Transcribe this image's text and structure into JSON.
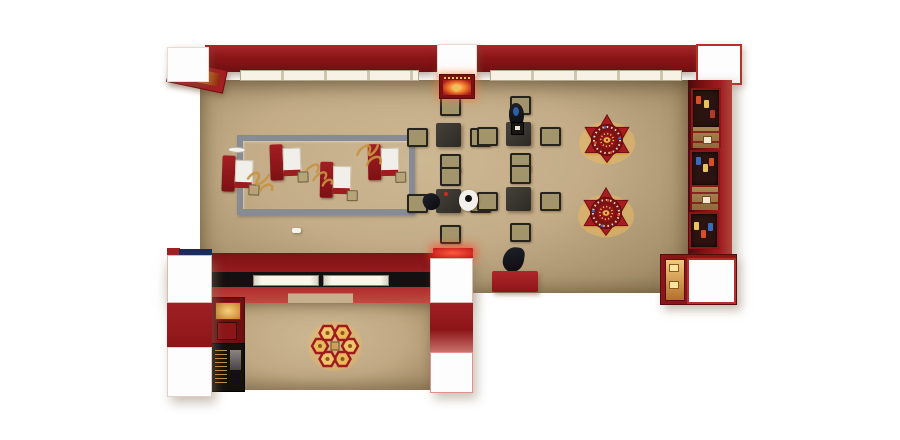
{
  "scene": {
    "description": "Top-down 3D render of an L-shaped red and beige jewelry showroom with display counters, consultation desks and tables",
    "background": "#ffffff"
  },
  "palette": {
    "wall_red_dark": "#7d1216",
    "wall_red": "#9e1c20",
    "wall_red_bright": "#c2493f",
    "floor_tan": "#c2ab87",
    "floor_shadow": "#8d7957",
    "frame_gray": "#878c94",
    "table_charcoal": "#38342f",
    "chair_khaki": "#a2956b",
    "glow_amber": "#f2bd62",
    "gold": "#d8a94e",
    "navy": "#1b2a5c",
    "light_panel": "#f6f1e4",
    "white": "#ffffff"
  },
  "inventory": {
    "consultation_desks": 4,
    "square_tables": 4,
    "chairs_per_table": 4,
    "flower_display_counters": 2,
    "hex_pod_clusters": 1,
    "hex_pods": 6,
    "wall_cabinets": 3,
    "wood_dividers": 2,
    "ceiling_light_strips": 2,
    "extension_light_panels": 2,
    "people_figures": 4,
    "floor_calligraphy_marks": 3,
    "illuminated_signs": 3,
    "corner_display_cases": 2
  },
  "labels": {
    "main_room": "main showroom",
    "extension": "front counter annex",
    "consultation_zone": "gray framed consultation zone",
    "reception": "reception desk"
  }
}
